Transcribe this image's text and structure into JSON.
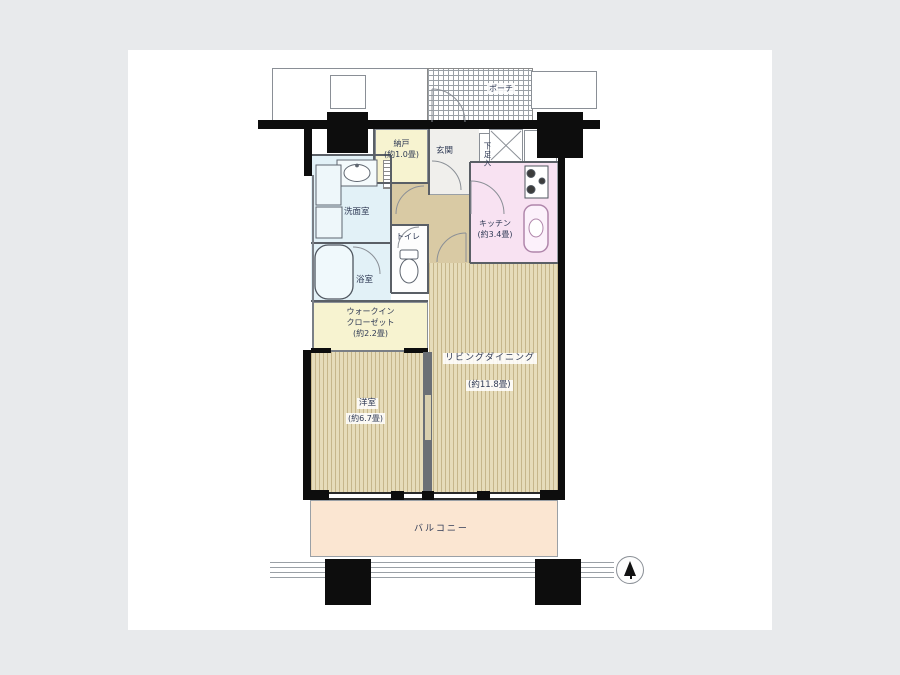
{
  "meta": {
    "type": "apartment-floor-plan",
    "page_bg": "#e8eaec",
    "panel_bg": "#ffffff"
  },
  "palette": {
    "wall": "#0d0d0d",
    "tatami_base": "#e6dcba",
    "tatami_stripe": "#c6b68b",
    "yellow_room": "#f7f3d0",
    "blue_room": "#e2f1f7",
    "pink_room": "#f8e2f2",
    "hall": "#d9caa4",
    "balcony": "#fbe6d2",
    "entrance_floor": "#f0efec",
    "label_text": "#2f3a55"
  },
  "rooms": {
    "porch": {
      "label": "ポーチ"
    },
    "storage": {
      "label": "納戸",
      "size": "(約1.0畳)"
    },
    "entrance": {
      "label": "玄関"
    },
    "shoe_cabinet": {
      "label": "下足入"
    },
    "kitchen": {
      "label": "キッチン",
      "size": "(約3.4畳)"
    },
    "washroom": {
      "label": "洗面室"
    },
    "bathroom": {
      "label": "浴室"
    },
    "toilet": {
      "label": "トイレ"
    },
    "walk_in_closet": {
      "line1": "ウォークイン",
      "line2": "クローゼット",
      "size": "(約2.2畳)"
    },
    "living_dining": {
      "label": "リビングダイニング",
      "size": "(約11.8畳)"
    },
    "bedroom": {
      "label": "洋室",
      "size": "(約6.7畳)"
    },
    "balcony": {
      "label": "バルコニー"
    }
  },
  "compass": {
    "icon": "north-arrow"
  }
}
